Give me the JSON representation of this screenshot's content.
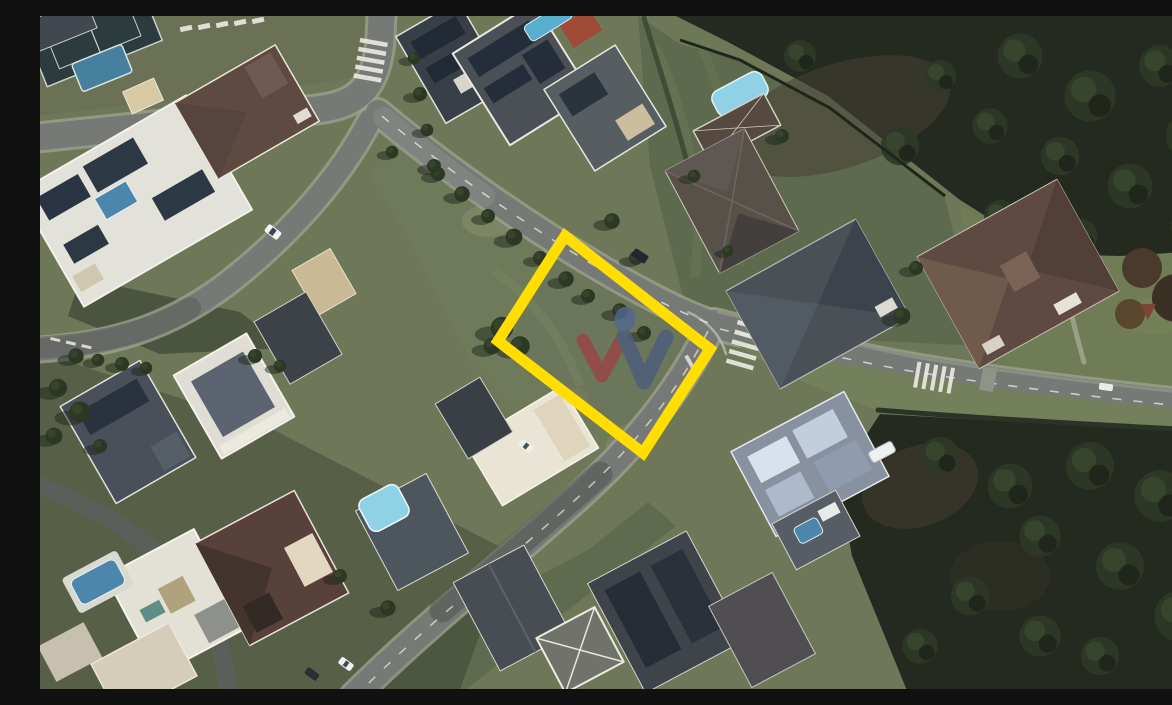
{
  "image": {
    "kind": "satellite-aerial-photo",
    "scene": "Top-down satellite view of a gated residential neighborhood: curving gray streets with white crosswalks and dashed center lines, houses with white, gray and brown roofs, rooftop solar panels and swimming pools, large lawns, dense dark forest in the upper-right and lower-right corners, and a vacant grass corner lot outlined with a thick yellow rectangle bearing a red-and-blue W logo watermark"
  },
  "lot_highlight": {
    "shape": "rotated-rectangle",
    "color": "#FFDE00",
    "border_px": 11,
    "fill": "transparent"
  },
  "watermark": {
    "name": "w-logo",
    "red_check": "#9A4646",
    "blue_check": "#4C5E7E",
    "blue_dot": "#51688F",
    "opacity": 0.82
  },
  "palette": {
    "lawn": "#6E7858",
    "lawn_bright": "#79855F",
    "forest": "#242A20",
    "road": "#767976",
    "road_marking": "#ECECE4",
    "roof_white": "#E3E2DA",
    "roof_brown": "#5E4A41",
    "roof_gray": "#4A5056",
    "pool_blue": "#4C86AC",
    "pool_cyan": "#8FD2E6",
    "solar_panel": "#2A3442",
    "shadow": "#2A2F26"
  }
}
